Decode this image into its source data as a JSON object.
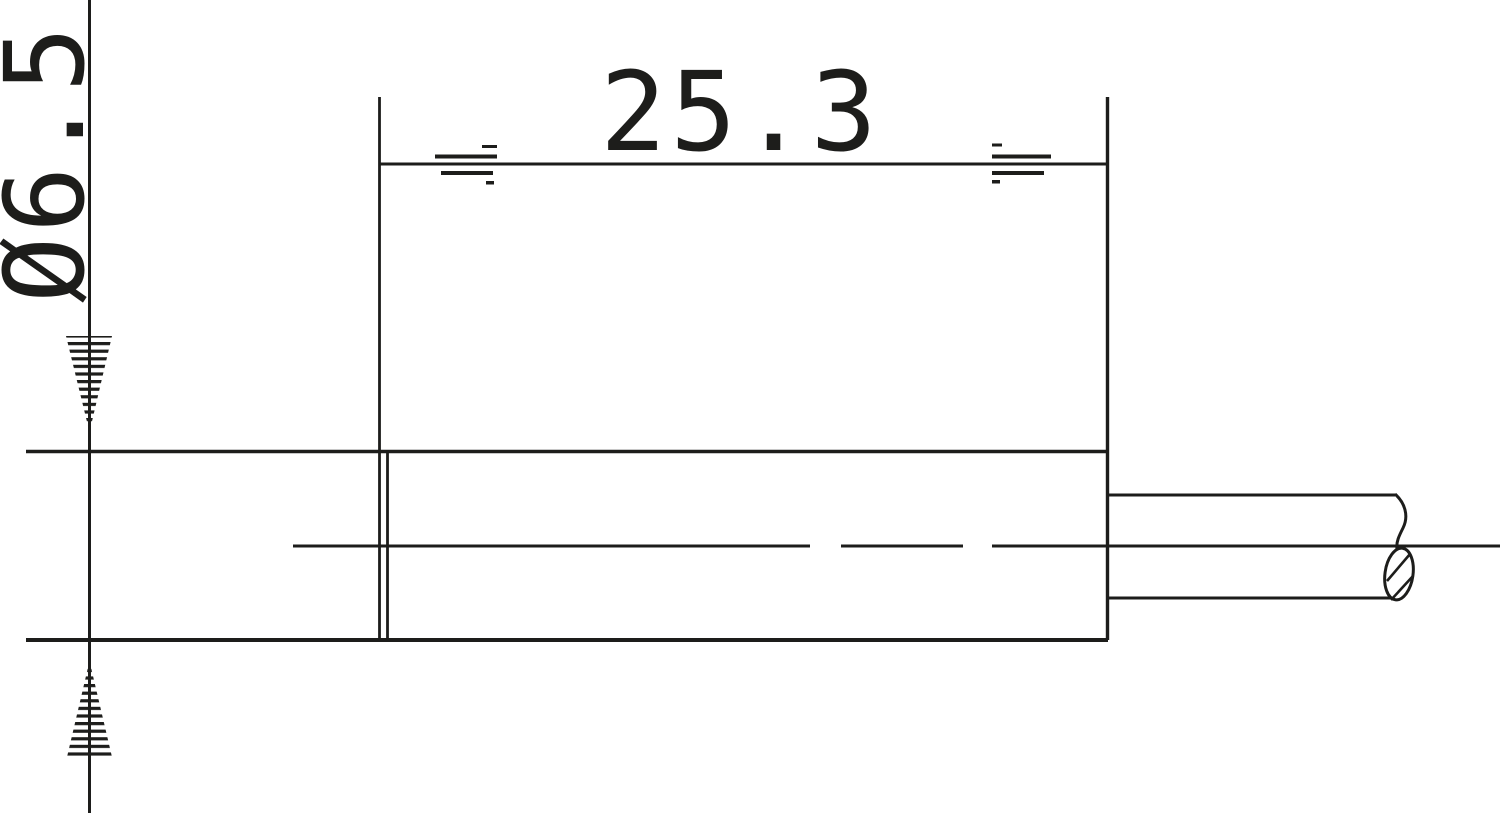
{
  "drawing": {
    "background": "#ffffff",
    "stroke_color": "#1d1d1b",
    "dimensions": {
      "diameter_label": "Ø6.5",
      "length_label": "25.3"
    }
  }
}
